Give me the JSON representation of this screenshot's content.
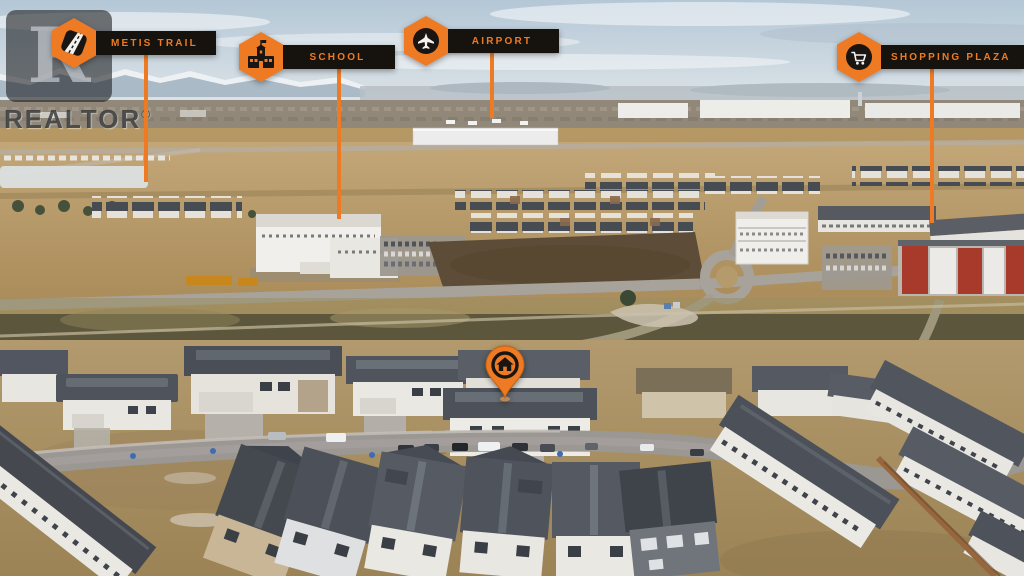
{
  "watermark": {
    "brand": "REALTOR",
    "registered": "®",
    "logo_letter": "R"
  },
  "colors": {
    "accent_orange": "#EE7B23",
    "label_background": "#16130F",
    "label_text": "#EE7B23",
    "pointer_line": "#EE7B23"
  },
  "markers": [
    {
      "id": "metis-trail",
      "label": "METIS TRAIL",
      "icon": "road-icon"
    },
    {
      "id": "school",
      "label": "SCHOOL",
      "icon": "school-building-icon"
    },
    {
      "id": "airport",
      "label": "AIRPORT",
      "icon": "airplane-icon"
    },
    {
      "id": "shopping-plaza",
      "label": "SHOPPING PLAZA",
      "icon": "shopping-cart-icon"
    }
  ],
  "property_marker": {
    "id": "featured-home",
    "icon": "home-icon"
  }
}
